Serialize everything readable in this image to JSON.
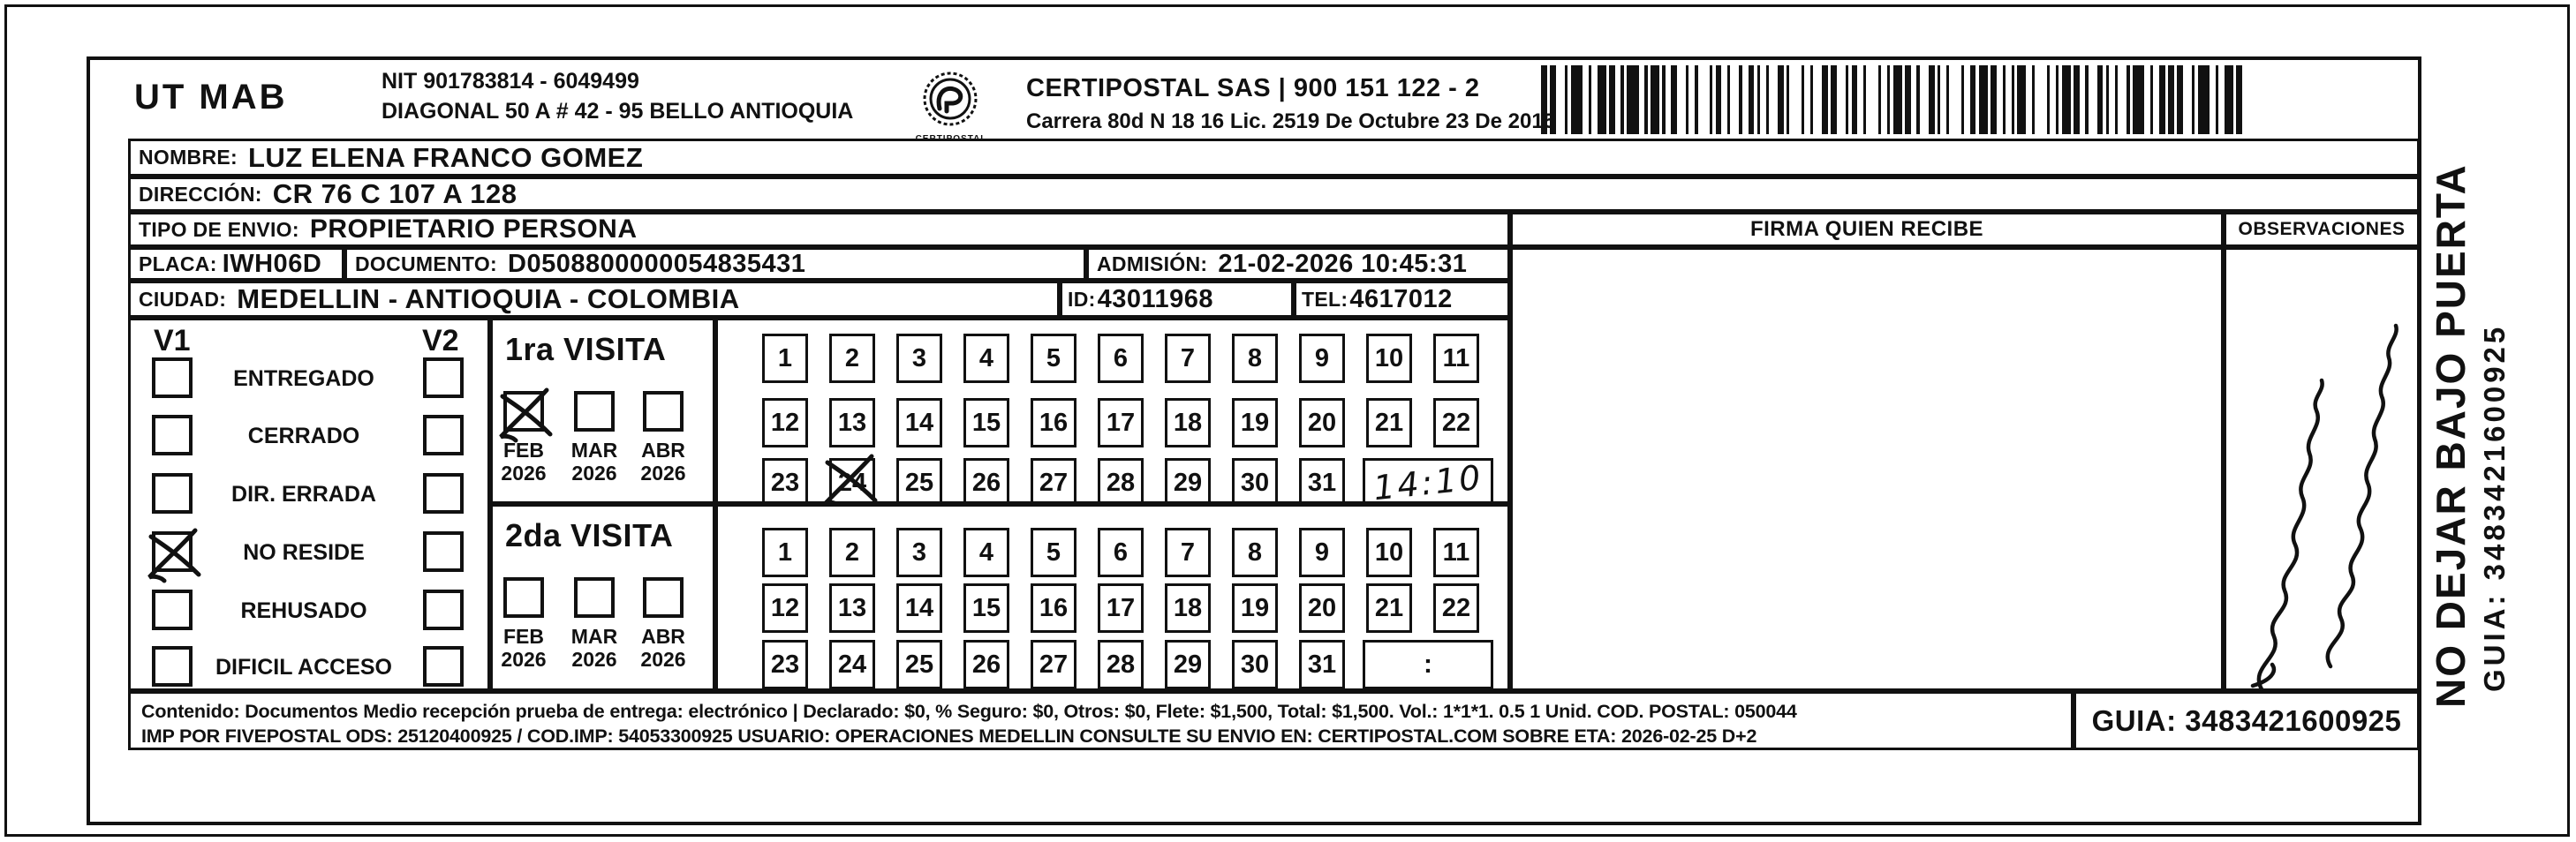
{
  "colors": {
    "ink": "#111111",
    "paper": "#ffffff"
  },
  "header": {
    "sender": "UT MAB",
    "nit": "NIT 901783814 - 6049499",
    "address": "DIAGONAL 50 A # 42 - 95  BELLO  ANTIOQUIA",
    "logo_caption": "CERTIPOSTAL",
    "company": "CERTIPOSTAL SAS | 900 151 122 - 2",
    "license": "Carrera 80d N 18 16  Lic. 2519 De Octubre 23 De 2015"
  },
  "recipient": {
    "nombre_label": "NOMBRE:",
    "nombre": "LUZ ELENA FRANCO GOMEZ",
    "direccion_label": "DIRECCIÓN:",
    "direccion": "CR 76 C 107 A 128",
    "tipo_label": "TIPO DE ENVIO:",
    "tipo": "PROPIETARIO PERSONA",
    "placa_label": "PLACA:",
    "placa": "IWH06D",
    "documento_label": "DOCUMENTO:",
    "documento": "D0508800000054835431",
    "admision_label": "ADMISIÓN:",
    "admision": "21-02-2026 10:45:31",
    "ciudad_label": "CIUDAD:",
    "ciudad": "MEDELLIN - ANTIOQUIA - COLOMBIA",
    "id_label": "ID:",
    "id_value": "43011968",
    "tel_label": "TEL:",
    "tel": "4617012"
  },
  "panels": {
    "firma_header": "FIRMA QUIEN RECIBE",
    "observaciones_header": "OBSERVACIONES",
    "observaciones_note": "illegible handwritten cursive note (rotated)"
  },
  "status": {
    "v1": "V1",
    "v2": "V2",
    "options": [
      {
        "label": "ENTREGADO",
        "v1": false,
        "v2": false
      },
      {
        "label": "CERRADO",
        "v1": false,
        "v2": false
      },
      {
        "label": "DIR. ERRADA",
        "v1": false,
        "v2": false
      },
      {
        "label": "NO RESIDE",
        "v1": true,
        "v2": false
      },
      {
        "label": "REHUSADO",
        "v1": false,
        "v2": false
      },
      {
        "label": "DIFICIL ACCESO",
        "v1": false,
        "v2": false
      }
    ]
  },
  "visits": [
    {
      "title": "1ra VISITA",
      "months": [
        {
          "month": "FEB",
          "year": "2026",
          "checked": true
        },
        {
          "month": "MAR",
          "year": "2026",
          "checked": false
        },
        {
          "month": "ABR",
          "year": "2026",
          "checked": false
        }
      ],
      "days": [
        "1",
        "2",
        "3",
        "4",
        "5",
        "6",
        "7",
        "8",
        "9",
        "10",
        "11",
        "12",
        "13",
        "14",
        "15",
        "16",
        "17",
        "18",
        "19",
        "20",
        "21",
        "22",
        "23",
        "24",
        "25",
        "26",
        "27",
        "28",
        "29",
        "30",
        "31"
      ],
      "crossed_days": [
        24
      ],
      "time": "14:10",
      "time_handwritten": true
    },
    {
      "title": "2da VISITA",
      "months": [
        {
          "month": "FEB",
          "year": "2026",
          "checked": false
        },
        {
          "month": "MAR",
          "year": "2026",
          "checked": false
        },
        {
          "month": "ABR",
          "year": "2026",
          "checked": false
        }
      ],
      "days": [
        "1",
        "2",
        "3",
        "4",
        "5",
        "6",
        "7",
        "8",
        "9",
        "10",
        "11",
        "12",
        "13",
        "14",
        "15",
        "16",
        "17",
        "18",
        "19",
        "20",
        "21",
        "22",
        "23",
        "24",
        "25",
        "26",
        "27",
        "28",
        "29",
        "30",
        "31"
      ],
      "crossed_days": [],
      "time": ":",
      "time_handwritten": false
    }
  ],
  "footer": {
    "line1": "Contenido: Documentos Medio recepción prueba de entrega: electrónico | Declarado: $0, % Seguro: $0, Otros: $0, Flete: $1,500, Total: $1,500. Vol.: 1*1*1. 0.5  1 Unid. COD. POSTAL: 050044",
    "line2": "IMP POR FIVEPOSTAL ODS: 25120400925 / COD.IMP: 54053300925 USUARIO: OPERACIONES MEDELLIN CONSULTE SU ENVIO EN: CERTIPOSTAL.COM SOBRE ETA: 2026-02-25 D+2",
    "guia": "GUIA: 3483421600925"
  },
  "side": {
    "warning": "NO DEJAR BAJO PUERTA",
    "guia": "GUIA: 3483421600925"
  },
  "barcode": {
    "pattern": "2123114212312211421131122312141122131221121321141213212311221412113122132112141221312212113214121131221321121311421221"
  }
}
